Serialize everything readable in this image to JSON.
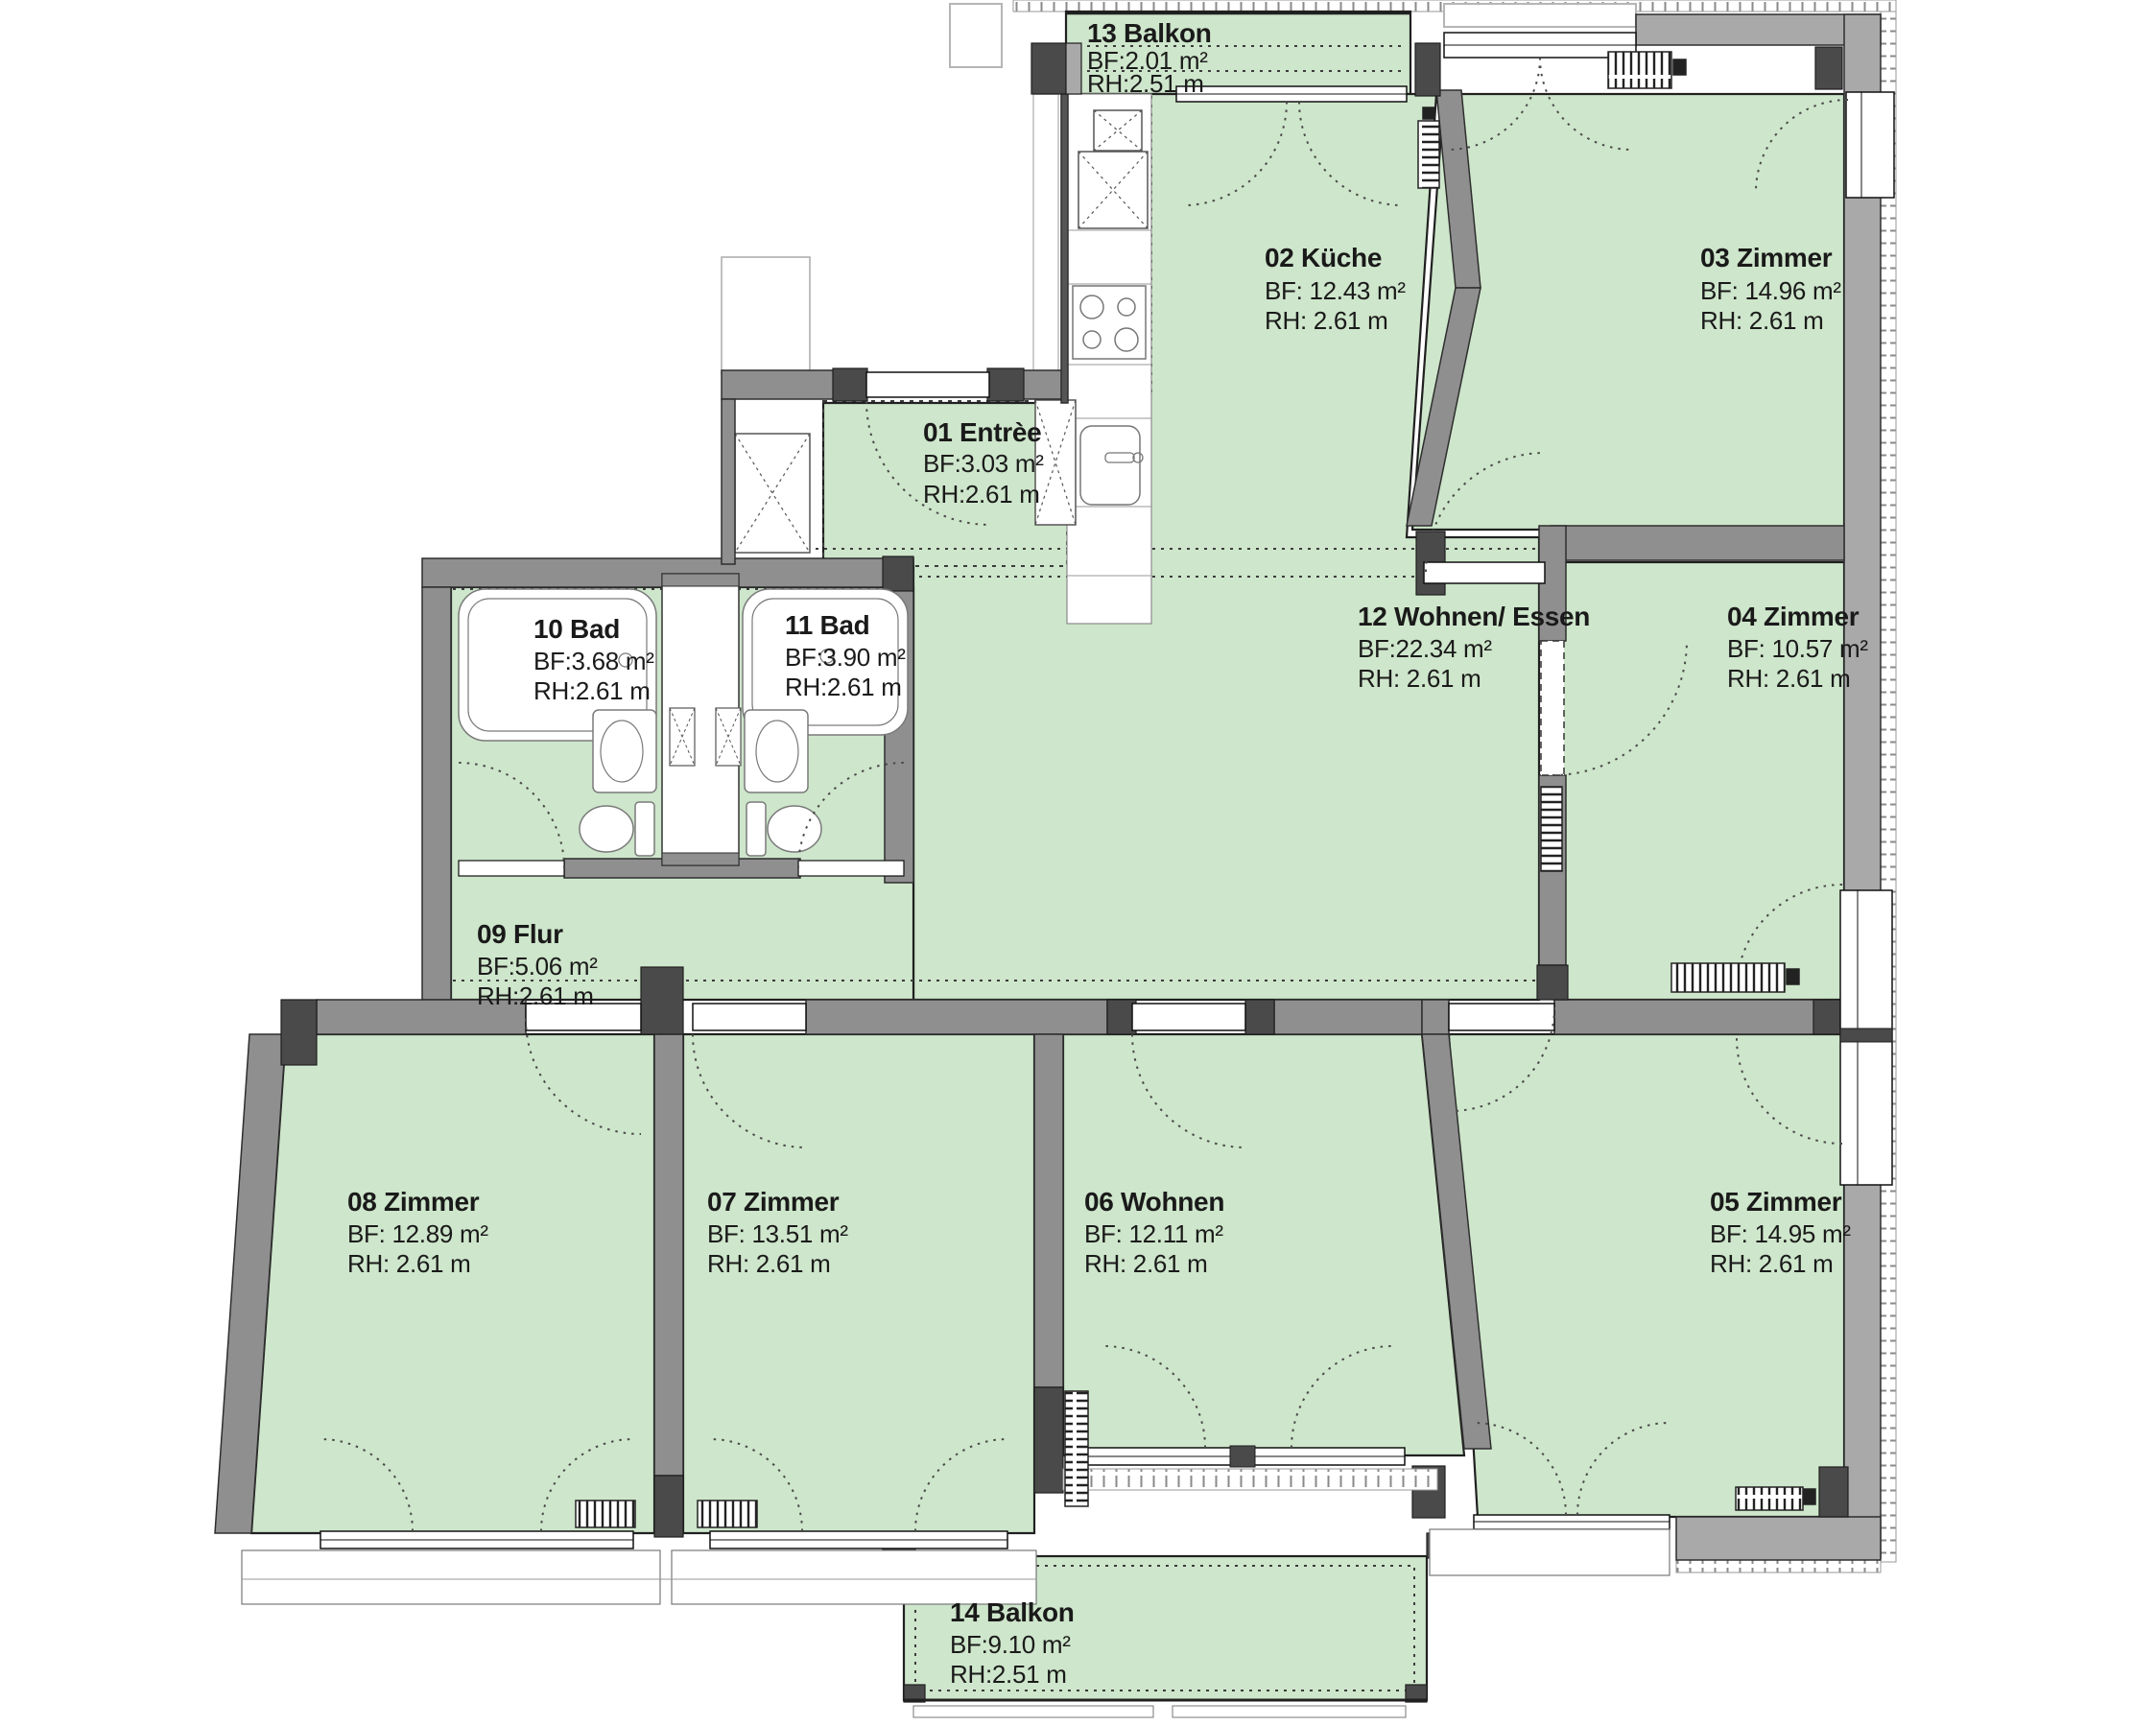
{
  "plan": {
    "type": "apartment-floor-plan",
    "language": "de",
    "colors": {
      "room_fill": "#cee6cb",
      "wall_interior": "#8f8f8f",
      "wall_exterior": "#a9a9a9",
      "wall_dark_post": "#4a4a4a",
      "outline": "#202020",
      "text": "#1a1a1a",
      "fixture_fill": "#ffffff"
    },
    "rooms": [
      {
        "id": "13",
        "label": "13 Balkon",
        "bf": "BF:2.01 m²",
        "rh": "RH:2.51 m"
      },
      {
        "id": "02",
        "label": "02 Küche",
        "bf": "BF: 12.43 m²",
        "rh": "RH:  2.61 m"
      },
      {
        "id": "03",
        "label": "03 Zimmer",
        "bf": "BF: 14.96 m²",
        "rh": "RH:  2.61 m"
      },
      {
        "id": "01",
        "label": "01 Entrèe",
        "bf": "BF:3.03 m²",
        "rh": "RH:2.61 m"
      },
      {
        "id": "12",
        "label": "12 Wohnen/ Essen",
        "bf": "BF:22.34 m²",
        "rh": "RH:  2.61 m"
      },
      {
        "id": "04",
        "label": "04 Zimmer",
        "bf": "BF: 10.57 m²",
        "rh": "RH:  2.61 m"
      },
      {
        "id": "10",
        "label": "10 Bad",
        "bf": "BF:3.68 m²",
        "rh": "RH:2.61 m"
      },
      {
        "id": "11",
        "label": "11 Bad",
        "bf": "BF:3.90 m²",
        "rh": "RH:2.61 m"
      },
      {
        "id": "09",
        "label": "09 Flur",
        "bf": "BF:5.06 m²",
        "rh": "RH:2.61 m"
      },
      {
        "id": "08",
        "label": "08 Zimmer",
        "bf": "BF: 12.89 m²",
        "rh": "RH:  2.61 m"
      },
      {
        "id": "07",
        "label": "07 Zimmer",
        "bf": "BF: 13.51 m²",
        "rh": "RH:  2.61 m"
      },
      {
        "id": "06",
        "label": "06 Wohnen",
        "bf": "BF: 12.11 m²",
        "rh": "RH:  2.61 m"
      },
      {
        "id": "05",
        "label": "05 Zimmer",
        "bf": "BF: 14.95 m²",
        "rh": "RH:  2.61 m"
      },
      {
        "id": "14",
        "label": "14 Balkon",
        "bf": "BF:9.10 m²",
        "rh": "RH:2.51 m"
      }
    ]
  }
}
